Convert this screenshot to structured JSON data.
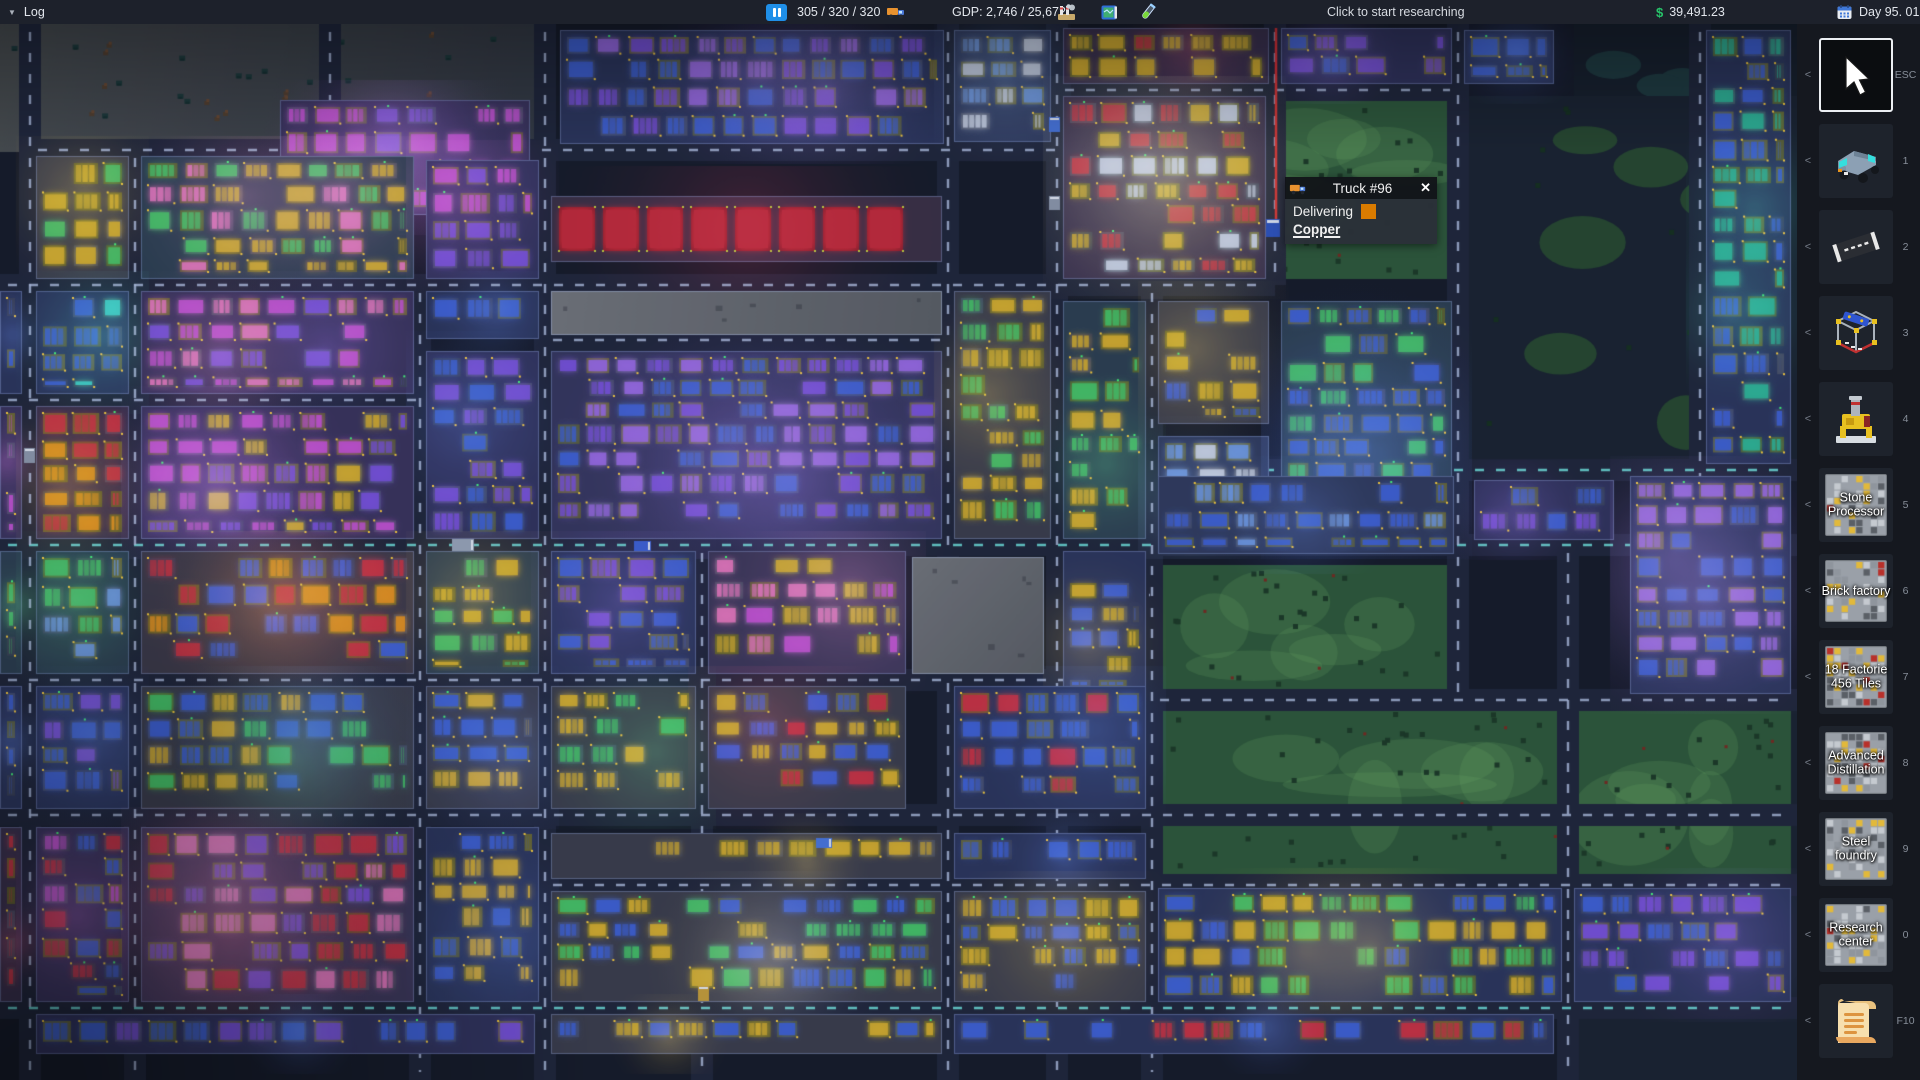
{
  "top_bar": {
    "log_arrow": "▼",
    "log_label": "Log",
    "vehicles": "305 / 320 / 320",
    "gdp": "GDP: 2,746 / 25,672",
    "research_hint": "Click to start researching",
    "money_symbol": "$",
    "money": "39,491.23",
    "date": "Day 95. 01:20"
  },
  "tooltip": {
    "title": "Truck #96",
    "close": "✕",
    "status": "Delivering",
    "cargo": "Copper",
    "cargo_color": "#d97b00"
  },
  "sidebar": {
    "chevron": "<",
    "items": [
      {
        "name": "select-tool",
        "hotkey": "ESC",
        "label": "",
        "selected": true
      },
      {
        "name": "vehicles-tool",
        "hotkey": "1",
        "label": ""
      },
      {
        "name": "road-tool",
        "hotkey": "2",
        "label": ""
      },
      {
        "name": "construction-tool",
        "hotkey": "3",
        "label": ""
      },
      {
        "name": "mine-tool",
        "hotkey": "4",
        "label": ""
      },
      {
        "name": "stone-processor",
        "hotkey": "5",
        "label": "Stone Processor"
      },
      {
        "name": "brick-factory",
        "hotkey": "6",
        "label": "Brick factory"
      },
      {
        "name": "factories-blueprint",
        "hotkey": "7",
        "label": "18 Factorie 456 Tiles"
      },
      {
        "name": "advanced-distillation",
        "hotkey": "8",
        "label": "Advanced Distillation"
      },
      {
        "name": "steel-foundry",
        "hotkey": "9",
        "label": "Steel foundry"
      },
      {
        "name": "research-center",
        "hotkey": "0",
        "label": "Research center"
      },
      {
        "name": "log-scroll",
        "hotkey": "F10",
        "label": ""
      }
    ]
  },
  "map": {
    "ground": "#161b29",
    "road": "#20263a",
    "dash": "rgba(175,190,225,0.85)",
    "dash_alt": "rgba(110,225,220,0.9)",
    "plot": "#2b3150",
    "park": "#2e5a3a",
    "park_light": "rgba(120,190,110,0.18)",
    "tree": "#1c3a26",
    "dirt_a": "#4a4e50",
    "dirt_b": "#343a44",
    "empty_a": "#74777d",
    "empty_b": "#5c6066",
    "route": "#e03030",
    "palette": {
      "magenta": "#c653d6",
      "purple": "#7a52e0",
      "violet": "#9a6ae8",
      "blue": "#3f62d8",
      "lightblue": "#6f9ae8",
      "cyan": "#3fd8cc",
      "teal": "#2fb89a",
      "orange": "#e8941f",
      "amber": "#d8b02f",
      "red": "#cc3344",
      "green": "#46c668",
      "pink": "#e878c0",
      "white": "#ccd6ea"
    }
  }
}
